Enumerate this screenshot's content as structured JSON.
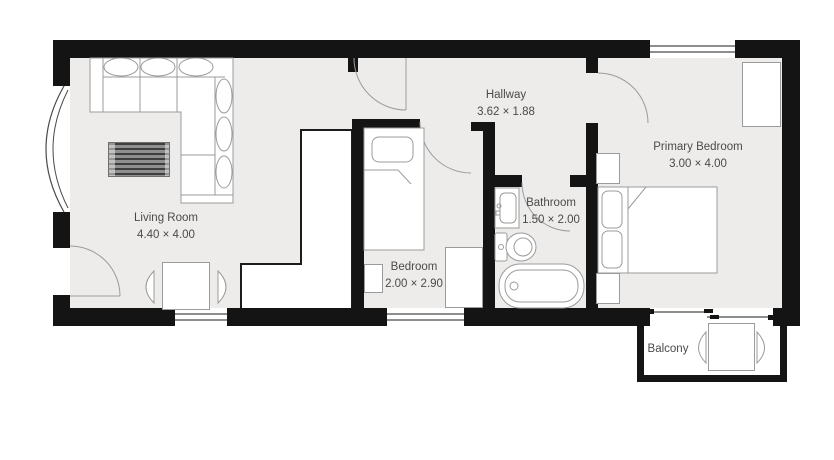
{
  "palette": {
    "wall": "#141414",
    "floor": "#edecea",
    "outline": "#9b9b9b",
    "text": "#4a4a4a",
    "rug_dark": "#3e3e3e",
    "rug_mid": "#8f8f8f"
  },
  "rooms": {
    "living_room": {
      "name": "Living Room",
      "dims": "4.40 × 4.00"
    },
    "hallway": {
      "name": "Hallway",
      "dims": "3.62 × 1.88"
    },
    "bedroom": {
      "name": "Bedroom",
      "dims": "2.00 × 2.90"
    },
    "bathroom": {
      "name": "Bathroom",
      "dims": "1.50 × 2.00"
    },
    "primary_bedroom": {
      "name": "Primary Bedroom",
      "dims": "3.00 × 4.00"
    },
    "balcony": {
      "name": "Balcony"
    }
  }
}
